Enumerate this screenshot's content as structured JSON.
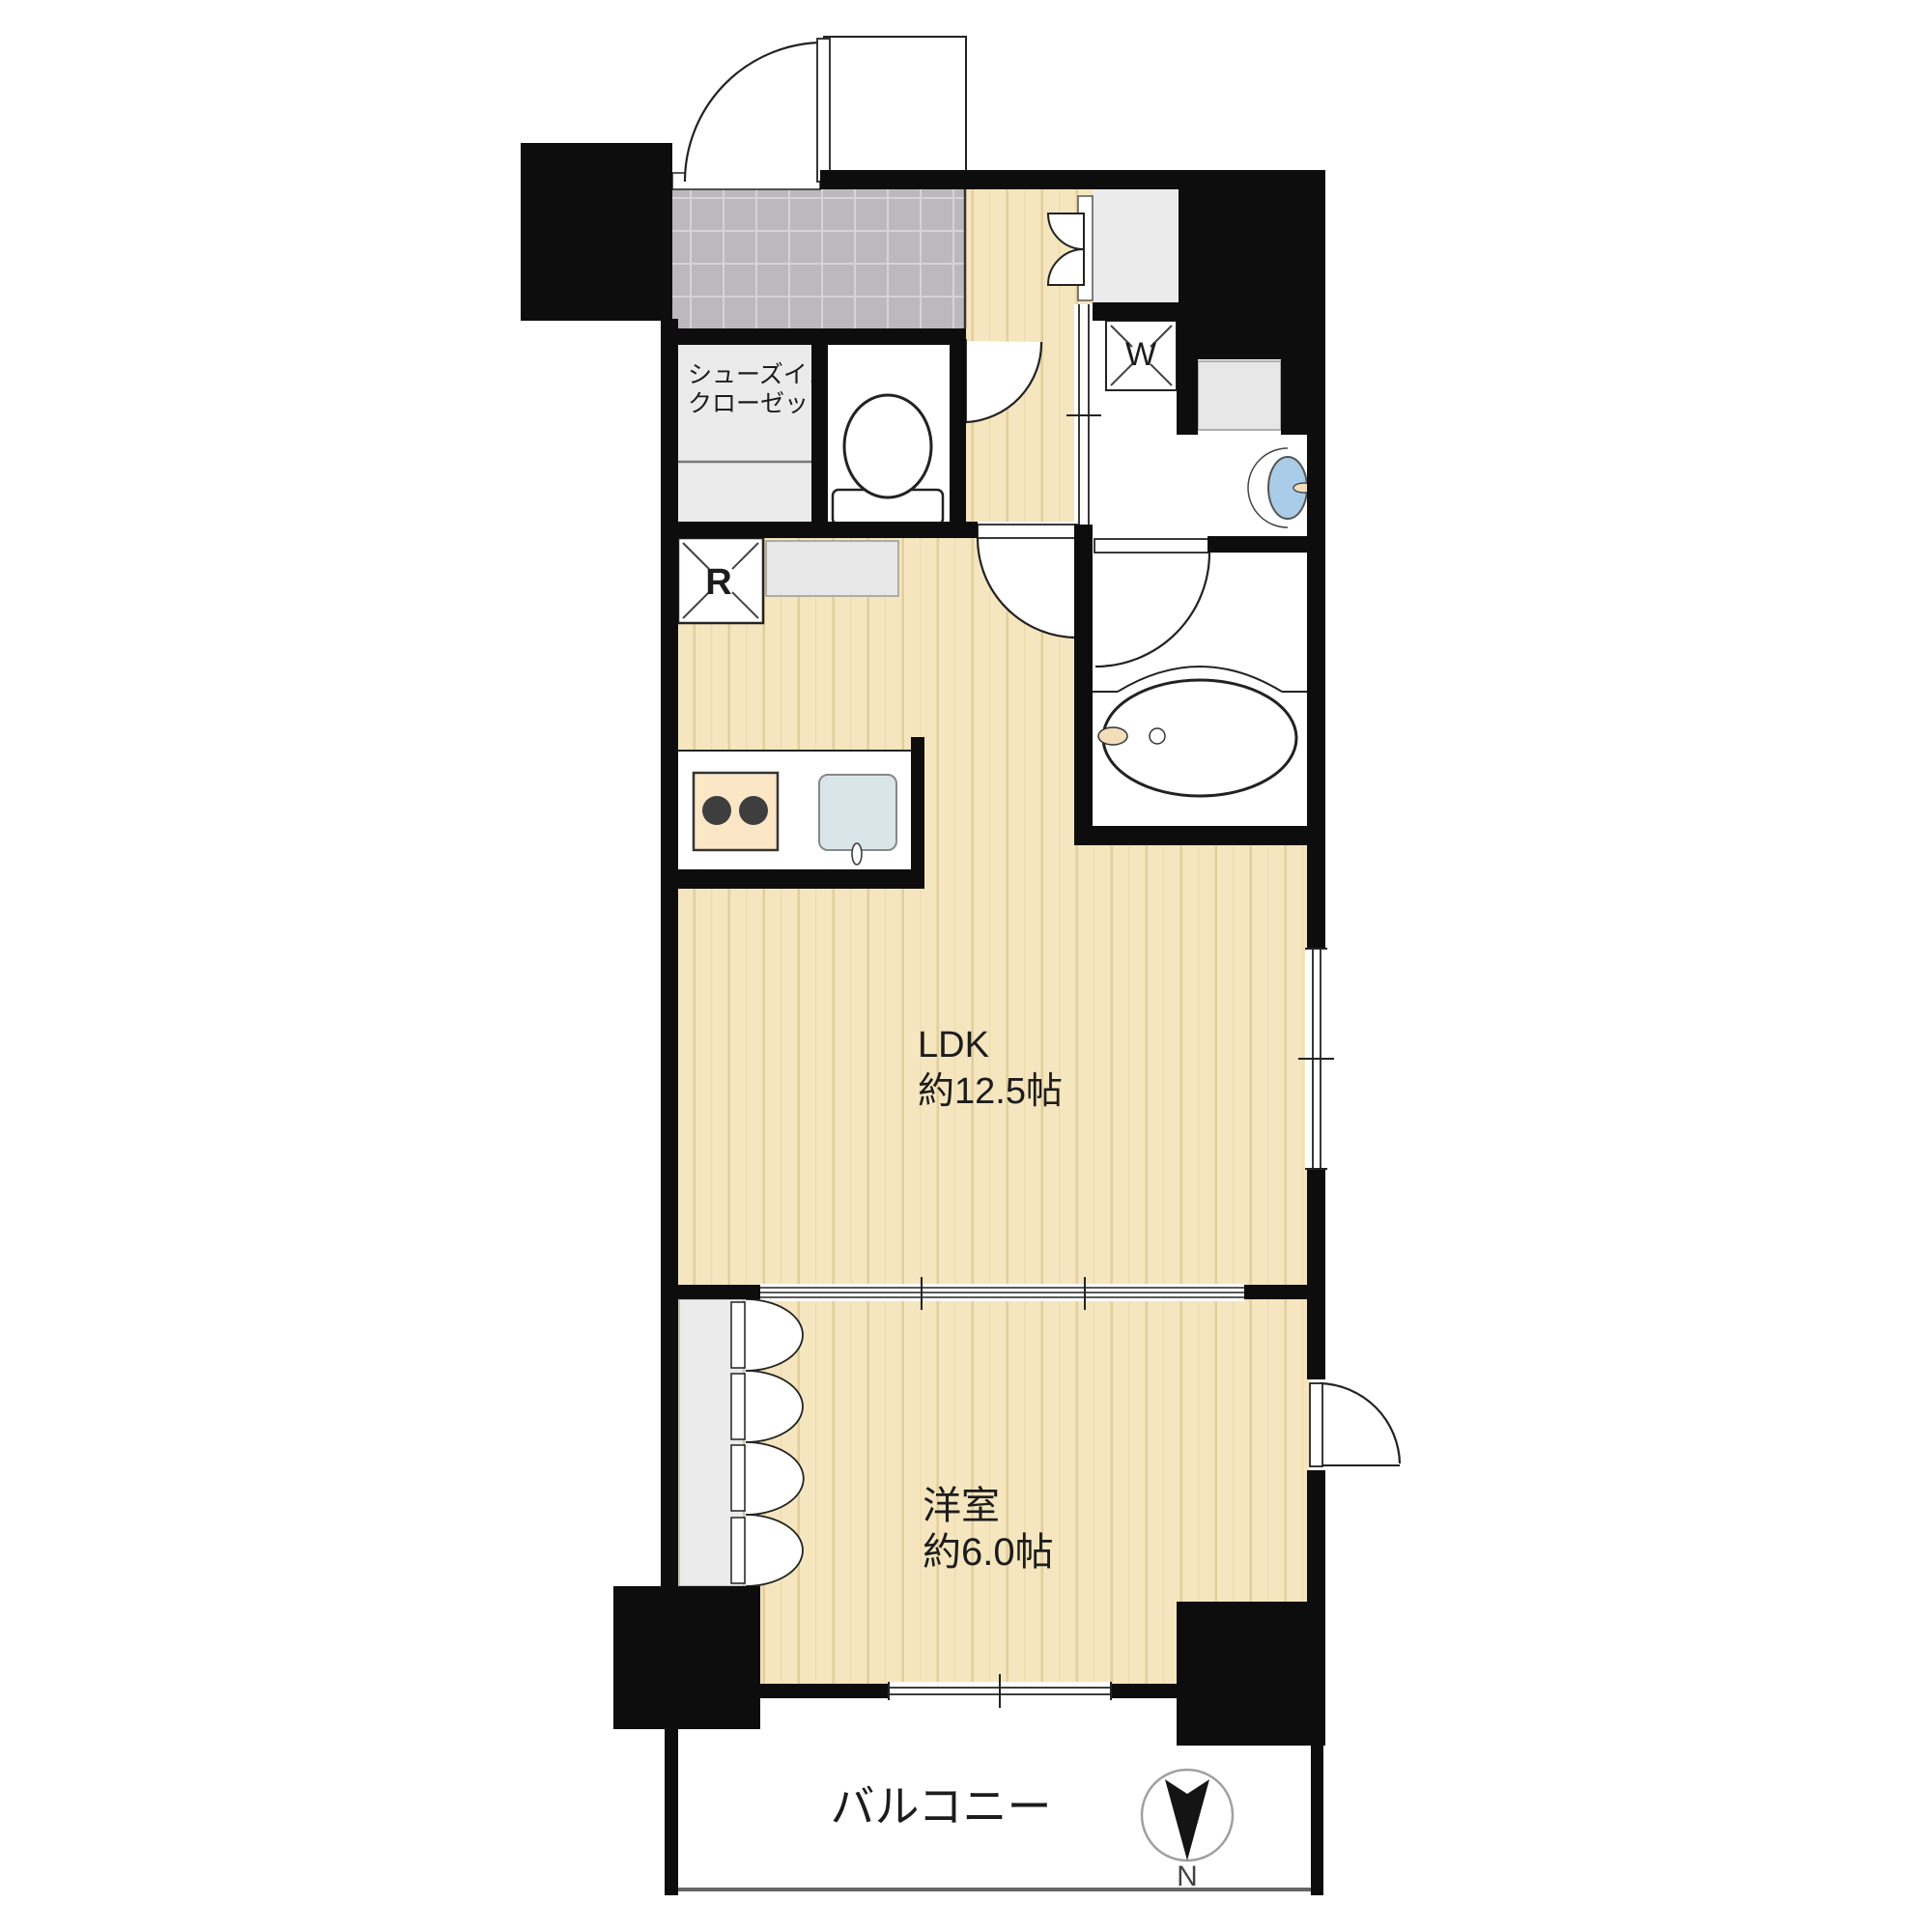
{
  "floor_plan": {
    "labels": {
      "shoe_closet_line1": "シューズイン",
      "shoe_closet_line2": "クローゼット",
      "washer_symbol": "W",
      "refrigerator_symbol": "R",
      "ldk_name": "LDK",
      "ldk_size": "約12.5帖",
      "bedroom_name": "洋室",
      "bedroom_size": "約6.0帖",
      "balcony_name": "バルコニー",
      "compass_north": "N"
    },
    "colors": {
      "wall": "#0d0d0d",
      "wood_floor": "#f5e6bf",
      "wood_grain": "#e0ca97",
      "tile_floor": "#bcb9bd",
      "tile_grout": "#d6d4d8",
      "closet_gray": "#ebebec",
      "counter_gray": "#e7e7e7",
      "sink_blue": "#a9cce8",
      "stove_beige": "#fbe7c6",
      "kitchen_sink_blue": "#d9e6e9",
      "faucet_beige": "#f2debb",
      "burner_dark": "#3e3e3e"
    }
  }
}
